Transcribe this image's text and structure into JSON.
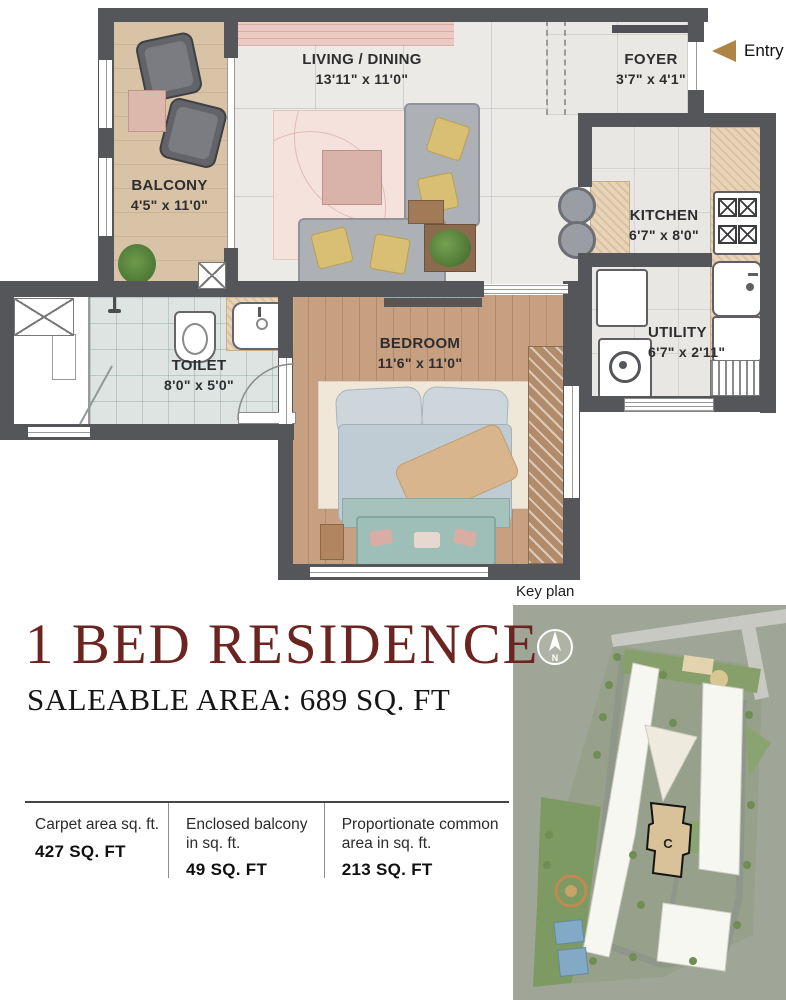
{
  "header": {
    "title": "1 BED RESIDENCE",
    "subtitle": "SALEABLE AREA: 689 SQ. FT"
  },
  "entry": {
    "label": "Entry"
  },
  "key_plan": {
    "label": "Key plan",
    "compass_label": "N",
    "highlighted_building": "C"
  },
  "rooms": [
    {
      "name": "LIVING / DINING",
      "dims": "13'11\" x 11'0\""
    },
    {
      "name": "FOYER",
      "dims": "3'7\" x 4'1\""
    },
    {
      "name": "BALCONY",
      "dims": "4'5\" x 11'0\""
    },
    {
      "name": "KITCHEN",
      "dims": "6'7\" x 8'0\""
    },
    {
      "name": "UTILITY",
      "dims": "6'7\" x 2'11\""
    },
    {
      "name": "TOILET",
      "dims": "8'0\" x 5'0\""
    },
    {
      "name": "BEDROOM",
      "dims": "11'6\" x 11'0\""
    }
  ],
  "areas": [
    {
      "label": "Carpet area sq. ft.",
      "value": "427 SQ. FT"
    },
    {
      "label": "Enclosed balcony in sq. ft.",
      "value": "49 SQ. FT"
    },
    {
      "label": "Proportionate common area in sq. ft.",
      "value": "213 SQ. FT"
    }
  ],
  "colors": {
    "accent": "#6b2420",
    "wall": "#55565a",
    "entry_arrow": "#b08445"
  }
}
